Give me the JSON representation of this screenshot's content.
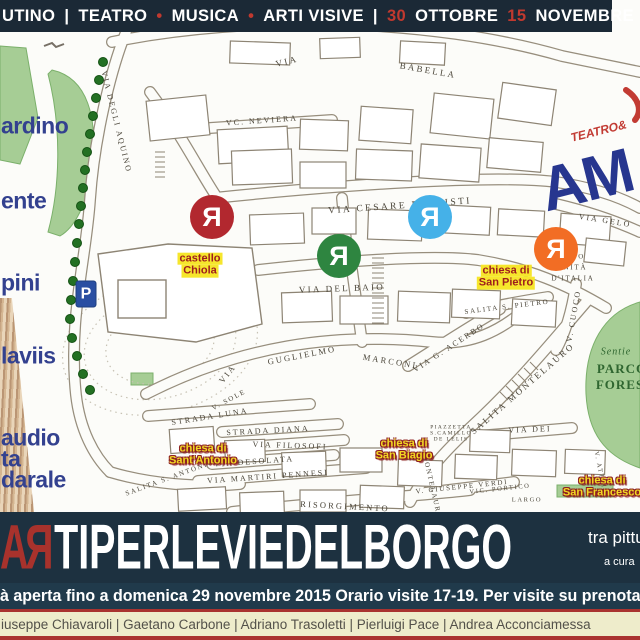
{
  "colors": {
    "banner_navy": "#1b2936",
    "title_navy": "#1d3140",
    "accent_red": "#c0392f",
    "credits_yellow": "#eeeccb",
    "label_highlight_yellow": "#f6e62c",
    "label_red": "#9e1d1d",
    "legend_blue": "#33418f",
    "park_green": "#2f6630"
  },
  "topbar": {
    "parts": [
      {
        "text": "UTINO",
        "red": false
      },
      {
        "text": "|",
        "red": false
      },
      {
        "text": "TEATRO",
        "red": false
      },
      {
        "text": "•",
        "red": true
      },
      {
        "text": "MUSICA",
        "red": false
      },
      {
        "text": "•",
        "red": true
      },
      {
        "text": "ARTI VISIVE",
        "red": false
      },
      {
        "text": "|",
        "red": false
      },
      {
        "text": "30",
        "red": true
      },
      {
        "text": "OTTOBRE",
        "red": false
      },
      {
        "text": "15",
        "red": true
      },
      {
        "text": "NOVEMBRE",
        "red": false
      },
      {
        "text": "2015",
        "red": true
      }
    ]
  },
  "logo": {
    "small": "TEATRO&",
    "big": "AM"
  },
  "legend": {
    "items": [
      {
        "text": "ardino",
        "y": 126
      },
      {
        "text": "ente",
        "y": 201
      },
      {
        "text": "pini",
        "y": 283
      },
      {
        "text": "laviis",
        "y": 356
      },
      {
        "text": "audio",
        "y": 438
      },
      {
        "text": "ta",
        "y": 459
      },
      {
        "text": "darale",
        "y": 480
      }
    ]
  },
  "map": {
    "street_labels": [
      {
        "t": "VIA",
        "x": 287,
        "y": 62,
        "r": -14,
        "s": 9
      },
      {
        "t": "BABELLA",
        "x": 428,
        "y": 71,
        "r": 10,
        "s": 9
      },
      {
        "t": "VC. NEVIERA",
        "x": 262,
        "y": 121,
        "r": -4,
        "s": 8
      },
      {
        "t": "VIA DEGLI AQUINO",
        "x": 116,
        "y": 122,
        "r": 76,
        "s": 8
      },
      {
        "t": "VIA CESARE BATTISTI",
        "x": 400,
        "y": 206,
        "r": -4,
        "s": 9.5
      },
      {
        "t": "VIA DEL BAIO",
        "x": 342,
        "y": 289,
        "r": -2,
        "s": 9
      },
      {
        "t": "VIA",
        "x": 228,
        "y": 374,
        "r": -52,
        "s": 8.5
      },
      {
        "t": "GUGLIELMO",
        "x": 302,
        "y": 356,
        "r": -11,
        "s": 8.5
      },
      {
        "t": "MARCONI",
        "x": 390,
        "y": 362,
        "r": 9,
        "s": 8.5
      },
      {
        "t": "STRADA LUNA",
        "x": 210,
        "y": 417,
        "r": -9,
        "s": 8
      },
      {
        "t": "STRADA DIANA",
        "x": 268,
        "y": 431,
        "r": -3,
        "s": 8
      },
      {
        "t": "VIA FILOSOFI",
        "x": 290,
        "y": 446,
        "r": 2,
        "s": 8
      },
      {
        "t": "VIA DESOLATA",
        "x": 254,
        "y": 462,
        "r": -4,
        "s": 8
      },
      {
        "t": "VIA MARTIRI PENNESI",
        "x": 268,
        "y": 477,
        "r": -4,
        "s": 8
      },
      {
        "t": "SALITA S. ANTONIO",
        "x": 170,
        "y": 478,
        "r": -20,
        "s": 7
      },
      {
        "t": "VIC. PORTICO",
        "x": 500,
        "y": 489,
        "r": -6,
        "s": 6.5
      },
      {
        "t": "SALITA S. PIETRO",
        "x": 507,
        "y": 307,
        "r": -7,
        "s": 7
      },
      {
        "t": "VIA G. ACERBO",
        "x": 449,
        "y": 348,
        "r": -33,
        "s": 8
      },
      {
        "t": "SALITA MONTELAURO",
        "x": 523,
        "y": 389,
        "r": -41,
        "s": 9
      },
      {
        "t": "V. CUOCO",
        "x": 574,
        "y": 316,
        "r": -80,
        "s": 8
      },
      {
        "t": "VIA DEI",
        "x": 530,
        "y": 430,
        "r": -2,
        "s": 8
      },
      {
        "t": "V. ATTEI",
        "x": 600,
        "y": 470,
        "r": 78,
        "s": 6.5
      },
      {
        "t": "VIA GELO",
        "x": 605,
        "y": 221,
        "r": 9,
        "s": 8
      },
      {
        "t": "RGO",
        "x": 575,
        "y": 257,
        "r": 0,
        "s": 7
      },
      {
        "t": "UNITÀ",
        "x": 572,
        "y": 268,
        "r": 0,
        "s": 7
      },
      {
        "t": "D'ITALIA",
        "x": 573,
        "y": 279,
        "r": 0,
        "s": 7
      },
      {
        "t": "V. GIUSEPPE VERDI",
        "x": 462,
        "y": 487,
        "r": -6,
        "s": 7
      },
      {
        "t": "LARGO",
        "x": 527,
        "y": 500,
        "r": 0,
        "s": 6.5
      },
      {
        "t": "MONTELAURO",
        "x": 432,
        "y": 487,
        "r": 77,
        "s": 7
      },
      {
        "t": "V. SOLE",
        "x": 229,
        "y": 400,
        "r": -28,
        "s": 7
      },
      {
        "t": "RISORGIMENTO",
        "x": 345,
        "y": 507,
        "r": 3,
        "s": 8.5
      },
      {
        "t": "PIAZZETTA",
        "x": 451,
        "y": 427,
        "r": 0,
        "s": 5.5
      },
      {
        "t": "S.CAMILLO",
        "x": 451,
        "y": 433,
        "r": 0,
        "s": 5.5
      },
      {
        "t": "DE LELIS",
        "x": 451,
        "y": 439,
        "r": 0,
        "s": 5.5
      }
    ],
    "markers": {
      "glyph": "Я",
      "items": [
        {
          "x": 212,
          "y": 217,
          "color": "#b2282f"
        },
        {
          "x": 339,
          "y": 256,
          "color": "#2e8540"
        },
        {
          "x": 430,
          "y": 217,
          "color": "#45b1e8"
        },
        {
          "x": 556,
          "y": 249,
          "color": "#f26d24"
        }
      ]
    },
    "places": [
      {
        "line1": "castello",
        "line2": "Chiola",
        "x": 200,
        "y": 265,
        "style": "hl"
      },
      {
        "line1": "chiesa di",
        "line2": "San Pietro",
        "x": 506,
        "y": 277,
        "style": "hl"
      },
      {
        "line1": "chiesa di",
        "line2": "Sant'Antonio",
        "x": 203,
        "y": 455,
        "style": "ol"
      },
      {
        "line1": "chiesa di",
        "line2": "San Biagio",
        "x": 404,
        "y": 450,
        "style": "ol"
      },
      {
        "line1": "chiesa di",
        "line2": "San Francesco",
        "x": 602,
        "y": 487,
        "style": "ol"
      }
    ],
    "parking": {
      "label": "P",
      "x": 86,
      "y": 294
    },
    "park_labels": [
      {
        "t": "Sentie",
        "x": 616,
        "y": 352,
        "s": 10,
        "italic": true
      },
      {
        "t": "PARCO",
        "x": 622,
        "y": 369,
        "s": 13,
        "bold": true
      },
      {
        "t": "FORES",
        "x": 620,
        "y": 385,
        "s": 13,
        "bold": true
      }
    ]
  },
  "title": {
    "prefix_a": "A",
    "prefix_r": "Я",
    "rest": "TIPERLEVIEDELBORGO",
    "right_top": "tra pittu",
    "right_bottom": "a cura"
  },
  "infobar": {
    "text": "à aperta fino a domenica 29 novembre 2015 Orario visite 17-19. Per visite su prenotazione telefona"
  },
  "credits": {
    "text": "iuseppe Chiavaroli | Gaetano Carbone | Adriano Trasoletti | Pierluigi Pace | Andrea Acconciamessa"
  }
}
